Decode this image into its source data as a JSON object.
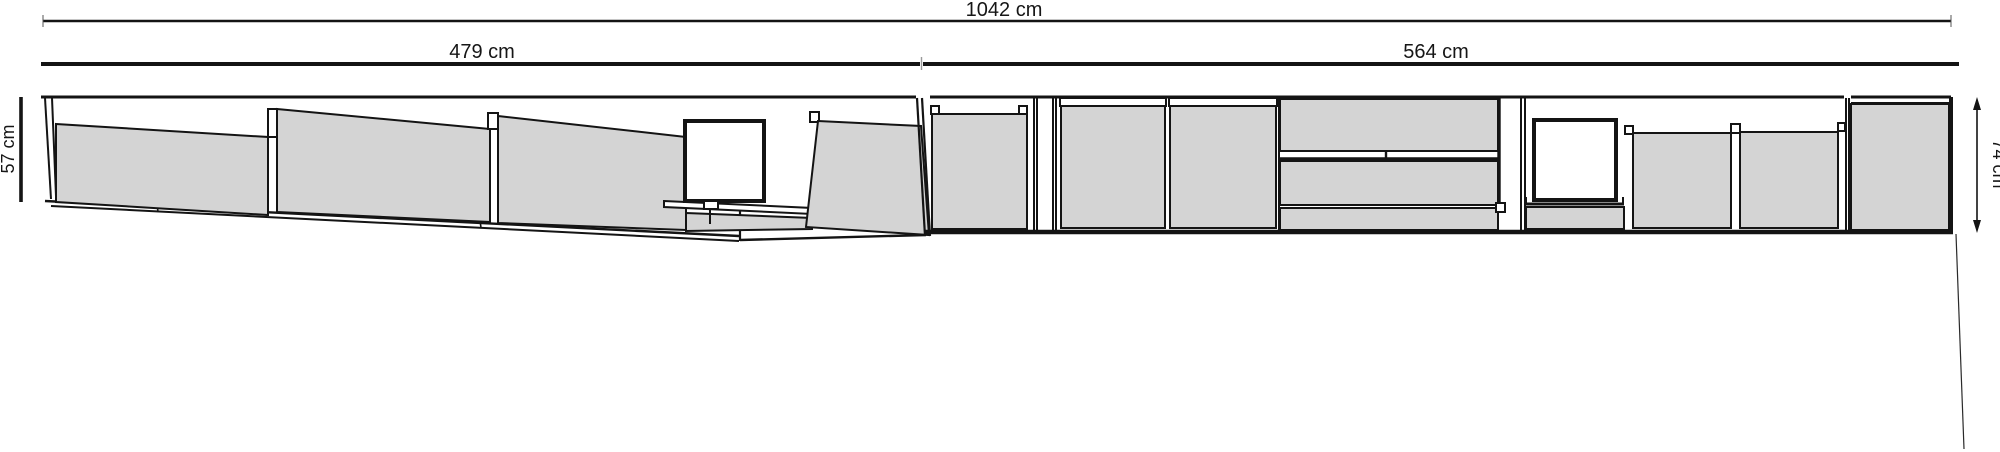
{
  "drawing": {
    "type": "furniture-elevation-diagram",
    "dimensions": {
      "total_width": "1042 cm",
      "left_wall_width": "479 cm",
      "right_wall_width": "564 cm",
      "left_height": "57 cm",
      "right_height": "74 cm"
    },
    "colors": {
      "panel_fill": "#d4d4d4",
      "line": "#141414",
      "background": "#ffffff"
    }
  }
}
